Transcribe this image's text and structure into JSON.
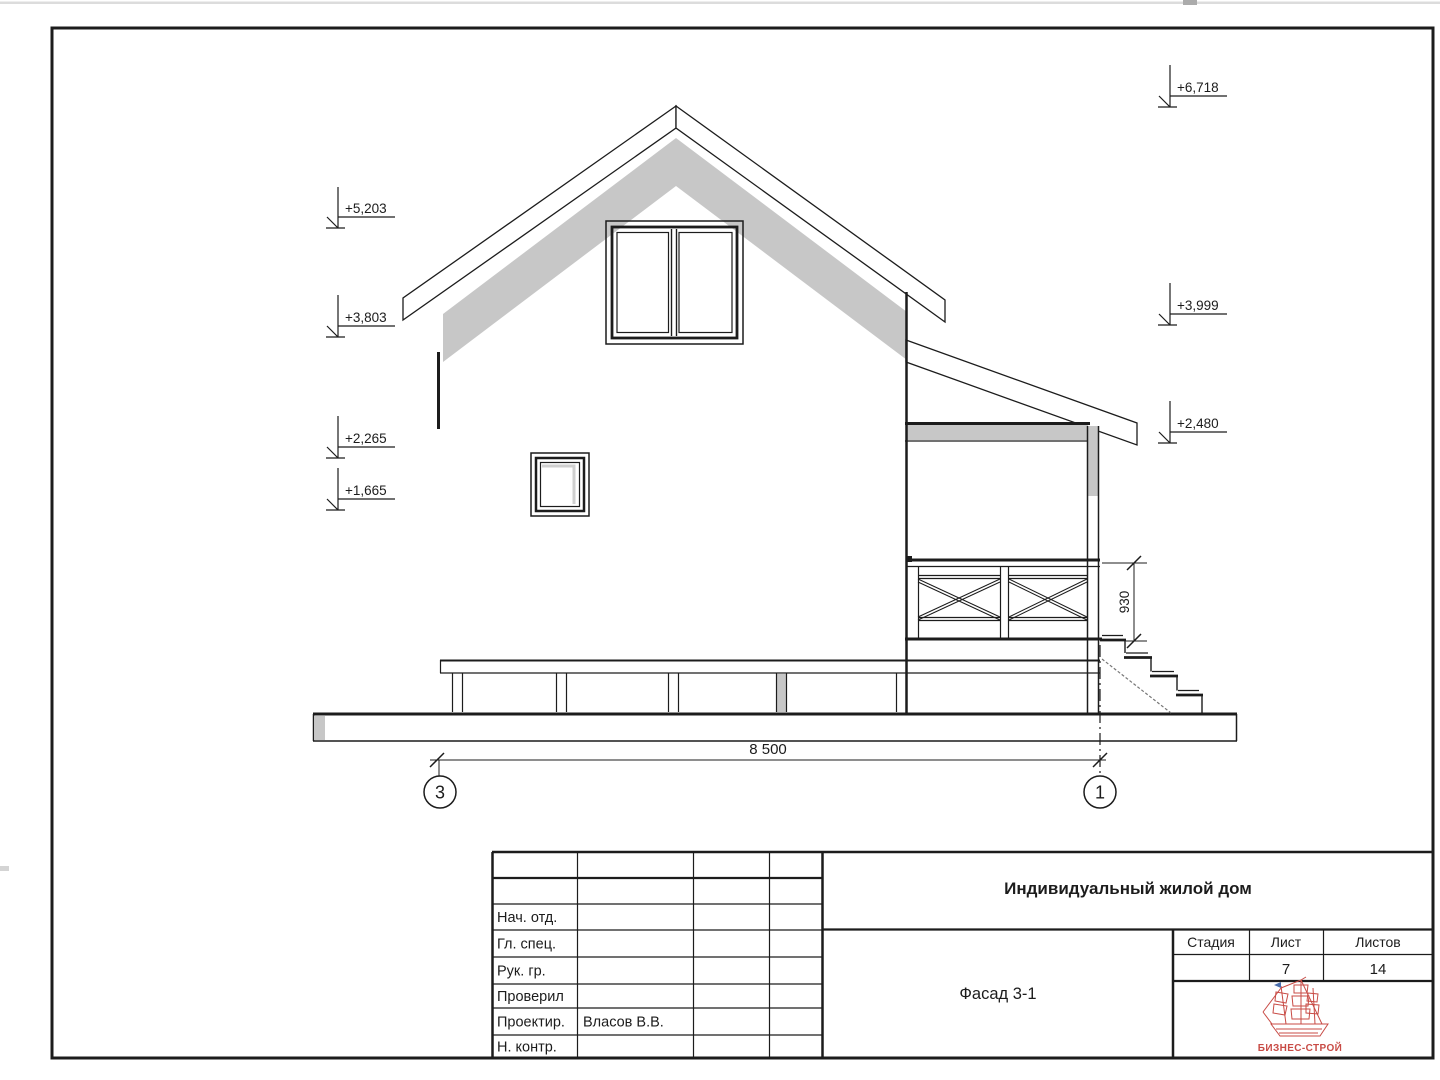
{
  "sheet": {
    "project_title": "Индивидуальный жилой дом",
    "drawing_title": "Фасад 3-1",
    "stage_label": "Стадия",
    "sheet_label": "Лист",
    "sheets_label": "Листов",
    "stage_value": "",
    "sheet_number": "7",
    "sheets_total": "14",
    "logo_text": "БИЗНЕС-СТРОЙ",
    "roles": [
      {
        "label": "Нач. отд.",
        "name": ""
      },
      {
        "label": "Гл. спец.",
        "name": ""
      },
      {
        "label": "Рук. гр.",
        "name": ""
      },
      {
        "label": "Проверил",
        "name": ""
      },
      {
        "label": "Проектир.",
        "name": "Власов В.В."
      },
      {
        "label": "Н. контр.",
        "name": ""
      }
    ]
  },
  "drawing": {
    "elevation_marks_left": [
      "+5,203",
      "+3,803",
      "+2,265",
      "+1,665"
    ],
    "elevation_marks_right": [
      "+6,718",
      "+3,999",
      "+2,480"
    ],
    "dim_overall_width": "8 500",
    "dim_railing_height": "930",
    "axis_left": "3",
    "axis_right": "1"
  },
  "colors": {
    "line": "#1c1c1c",
    "shadow": "#c7c7c7",
    "logo_red": "#c84b45",
    "flag_blue": "#4a6fae"
  }
}
